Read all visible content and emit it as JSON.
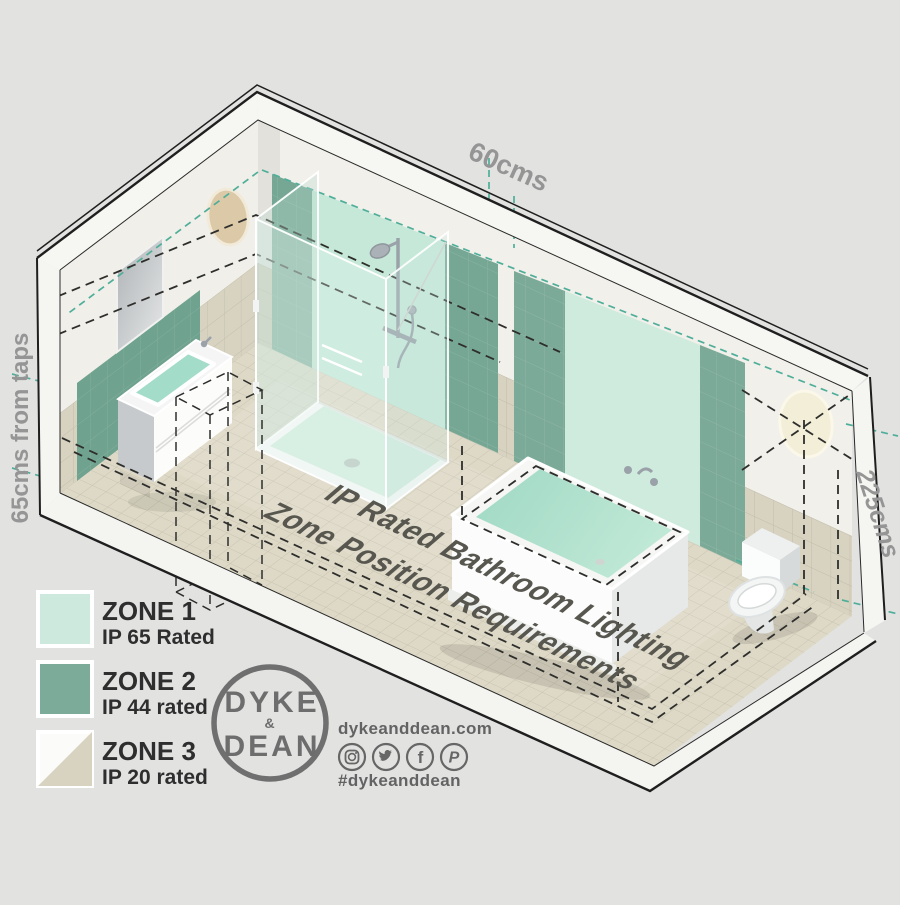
{
  "page": {
    "background": "#e2e2e1"
  },
  "diagram": {
    "caption_line1": "IP Rated Bathroom Lighting",
    "caption_line2": "Zone Position Requirements",
    "dim_top": "60cms",
    "dim_left": "65cms from taps",
    "dim_right": "225cms"
  },
  "legend": {
    "items": [
      {
        "zone": "ZONE 1",
        "rating": "IP 65 Rated",
        "color": "#cde9dd"
      },
      {
        "zone": "ZONE 2",
        "rating": "IP 44 rated",
        "color": "#7dab9a"
      },
      {
        "zone": "ZONE 3",
        "rating": "IP 20 rated",
        "color": "#d8d2c0"
      }
    ]
  },
  "colors": {
    "zone1_wall": "#c5e8d8",
    "zone1_wall_light": "#cfebdd",
    "zone2_wall": "#76a794",
    "zone2_wall_alt": "#7caa98",
    "zone2_left_wall": "#6fa28f",
    "teal_dash": "#4fae9a",
    "brand_gray": "#6d6d6d"
  },
  "branding": {
    "logo_top": "DYKE",
    "logo_amp": "&",
    "logo_bottom": "DEAN",
    "website": "dykeanddean.com",
    "hashtag": "#dykeanddean",
    "social_icons": [
      "instagram-icon",
      "twitter-icon",
      "facebook-icon",
      "pinterest-icon"
    ],
    "facebook_glyph": "f",
    "pinterest_glyph": "P"
  }
}
